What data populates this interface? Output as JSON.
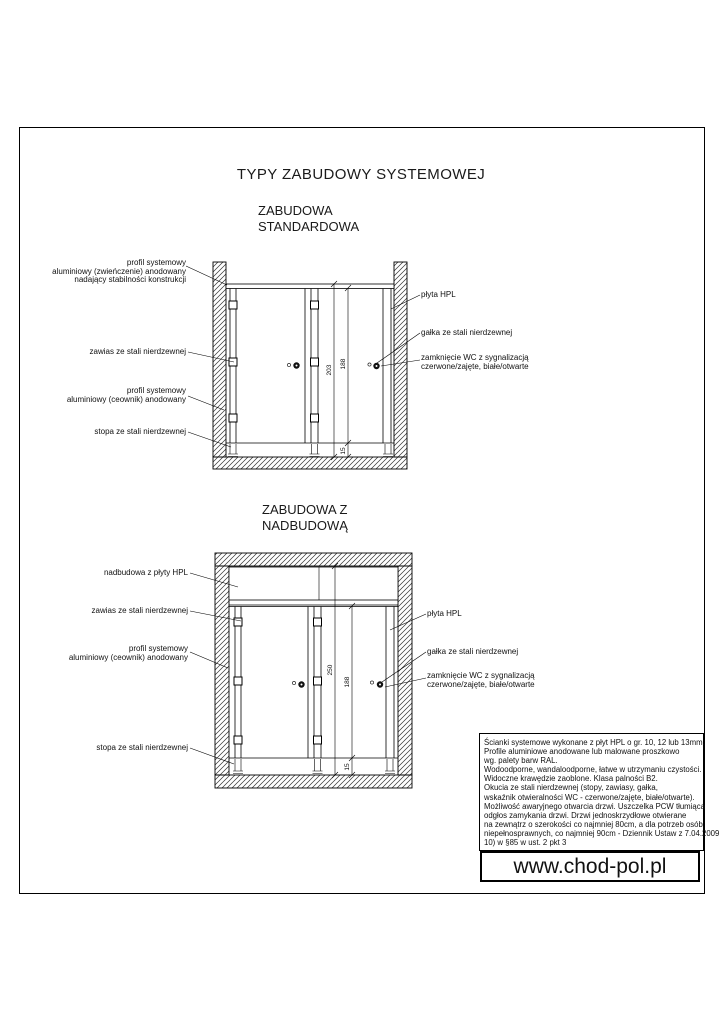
{
  "sheet": {
    "title": "TYPY ZABUDOWY SYSTEMOWEJ",
    "website": "www.chod-pol.pl"
  },
  "drawing1": {
    "subtitle": "ZABUDOWA\nSTANDARDOWA",
    "labels_left": [
      "profil systemowy\naluminiowy (zwieńczenie) anodowany\nnadający stabilności konstrukcji",
      "zawias ze stali nierdzewnej",
      "profil systemowy\naluminiowy (ceownik) anodowany",
      "stopa ze stali nierdzewnej"
    ],
    "labels_right": [
      "płyta HPL",
      "gałka ze stali nierdzewnej",
      "zamknięcie WC z sygnalizacją\nczerwone/zajęte, białe/otwarte"
    ],
    "dims": {
      "total": "203",
      "door": "188",
      "foot": "15"
    }
  },
  "drawing2": {
    "subtitle": "ZABUDOWA Z\nNADBUDOWĄ",
    "labels_left": [
      "nadbudowa z płyty HPL",
      "zawias ze stali nierdzewnej",
      "profil systemowy\naluminiowy (ceownik) anodowany",
      "stopa ze stali nierdzewnej"
    ],
    "labels_right": [
      "płyta HPL",
      "gałka ze stali nierdzewnej",
      "zamknięcie WC z sygnalizacją\nczerwone/zajęte, białe/otwarte"
    ],
    "dims": {
      "total": "250",
      "door": "188",
      "foot": "15"
    }
  },
  "spec": {
    "lines": [
      "Ścianki systemowe wykonane z płyt HPL o gr. 10, 12 lub 13mm.",
      "Profile aluminiowe anodowane lub malowane proszkowo",
      "wg. palety barw RAL.",
      "Wodoodporne, wandaloodporne, łatwe w utrzymaniu czystości.",
      "Widoczne krawędzie zaoblone. Klasa palności B2.",
      "Okucia ze stali nierdzewnej (stopy, zawiasy, gałka,",
      "wskaźnik otwieralności WC - czerwone/zajęte, białe/otwarte).",
      "Możliwość awaryjnego otwarcia drzwi. Uszczelka PCW tłumiąca",
      "odgłos zamykania drzwi. Drzwi jednoskrzydłowe otwierane",
      "na zewnątrz o szerokości co najmniej 80cm, a dla potrzeb osób",
      "niepełnosprawnych, co najmniej 90cm - Dziennik Ustaw z 7.04.2009",
      "10) w §85 w ust. 2 pkt 3"
    ]
  }
}
